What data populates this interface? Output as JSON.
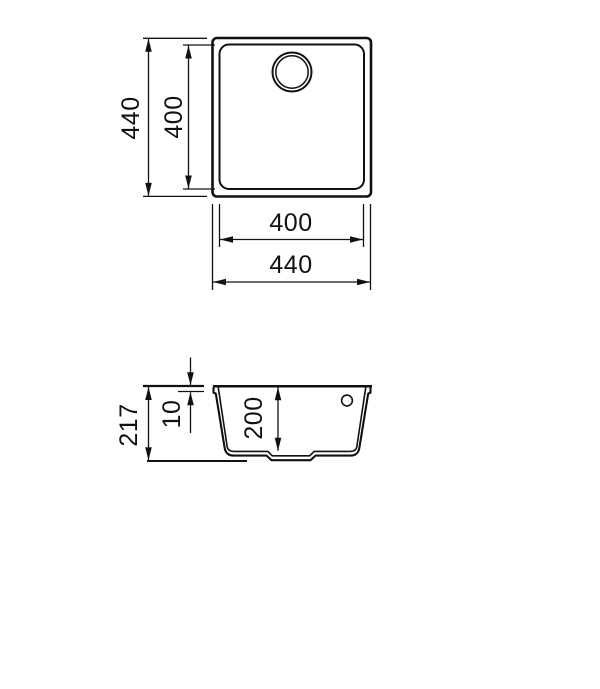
{
  "drawing": {
    "kind": "sink-dimension-diagram",
    "dims": {
      "top_view": {
        "outer_height": "440",
        "inner_height": "400",
        "inner_width": "400",
        "outer_width": "440"
      },
      "side_view": {
        "total_height": "217",
        "rim_thickness": "10",
        "bowl_depth": "200"
      }
    },
    "colors": {
      "line": "#111111",
      "background": "#ffffff"
    }
  }
}
